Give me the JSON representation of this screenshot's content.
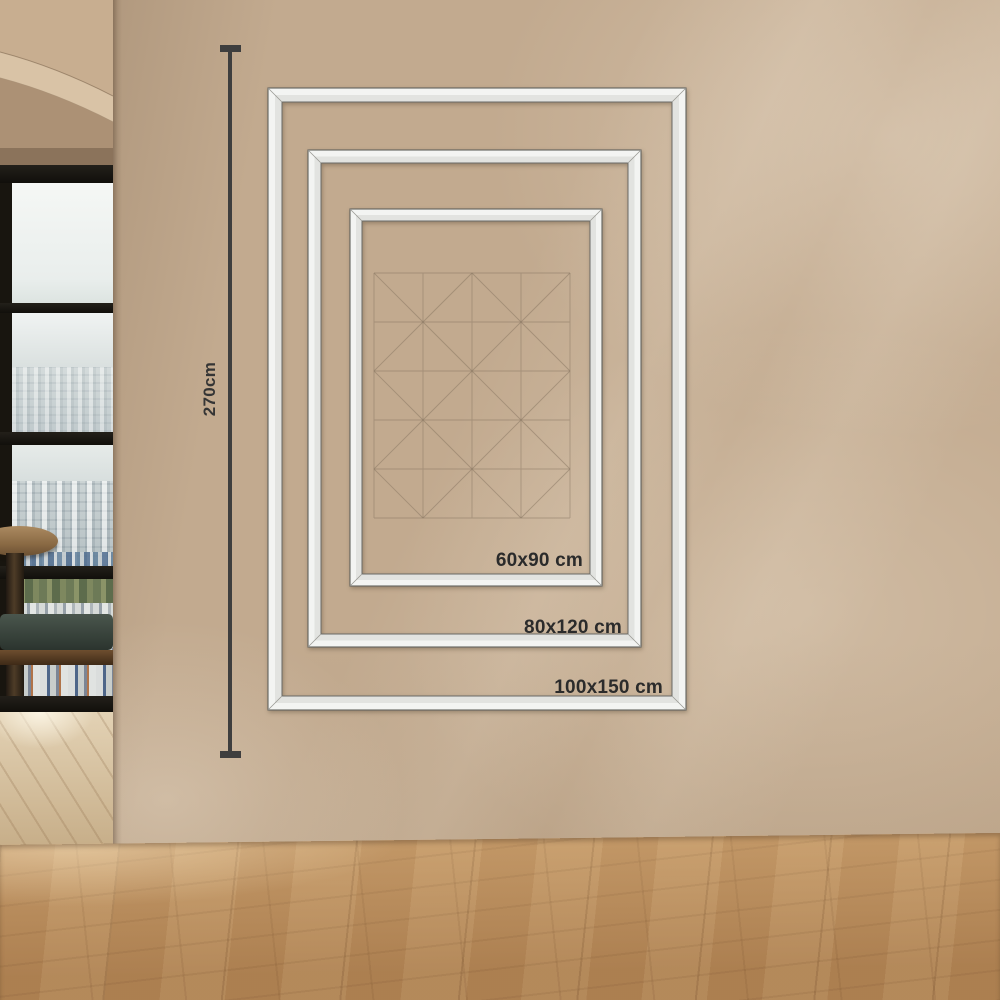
{
  "scene": {
    "wall_height_label": "270cm",
    "frame_sizes": [
      {
        "label": "60x90 cm"
      },
      {
        "label": "80x120 cm"
      },
      {
        "label": "100x150 cm"
      }
    ],
    "colors": {
      "wall": "#c2aa8f",
      "frame_fill": "#f3f4f2",
      "frame_outline": "#62625e",
      "dimension_line": "#3e3e3e",
      "label_text": "#2b2b2b",
      "floor_wood": "#b78c5c",
      "window_frame": "#18150f",
      "chair_upholstery": "#36413a",
      "artwork_lines": "#86735f"
    }
  }
}
